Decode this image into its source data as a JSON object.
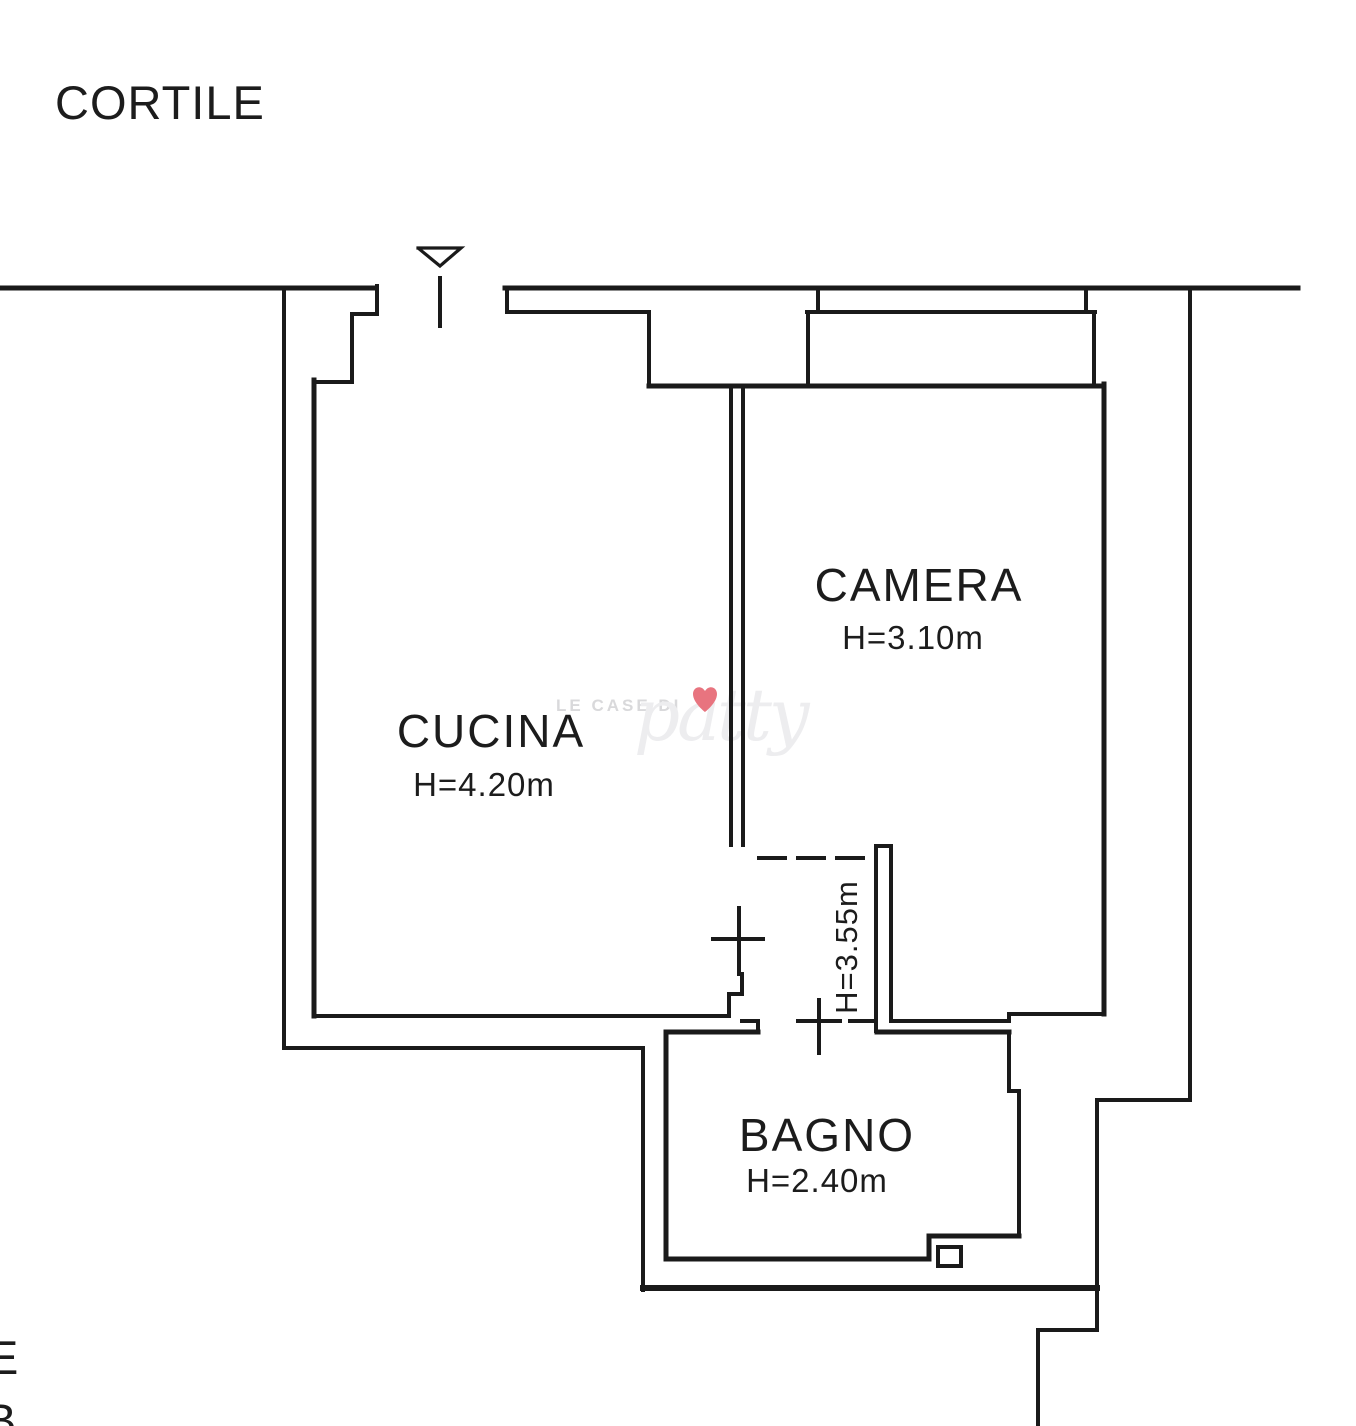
{
  "plan": {
    "courtyard_label": "CORTILE",
    "rooms": {
      "cucina": {
        "name": "CUCINA",
        "height": "H=4.20m"
      },
      "camera": {
        "name": "CAMERA",
        "height": "H=3.10m"
      },
      "bagno": {
        "name": "BAGNO",
        "height": "H=2.40m"
      },
      "corridoio": {
        "height": "H=3.55m"
      }
    },
    "edge_fragments": {
      "upper": "E",
      "lower": "B"
    },
    "watermark": {
      "prefix": "LE CASE DI",
      "script": "patty",
      "heart_icon": "heart",
      "heart_color": "#e8747f"
    },
    "colors": {
      "wall": "#1a1a1a",
      "background": "#ffffff",
      "watermark_prefix": "#d9d9db",
      "watermark_script": "#ededef"
    }
  }
}
